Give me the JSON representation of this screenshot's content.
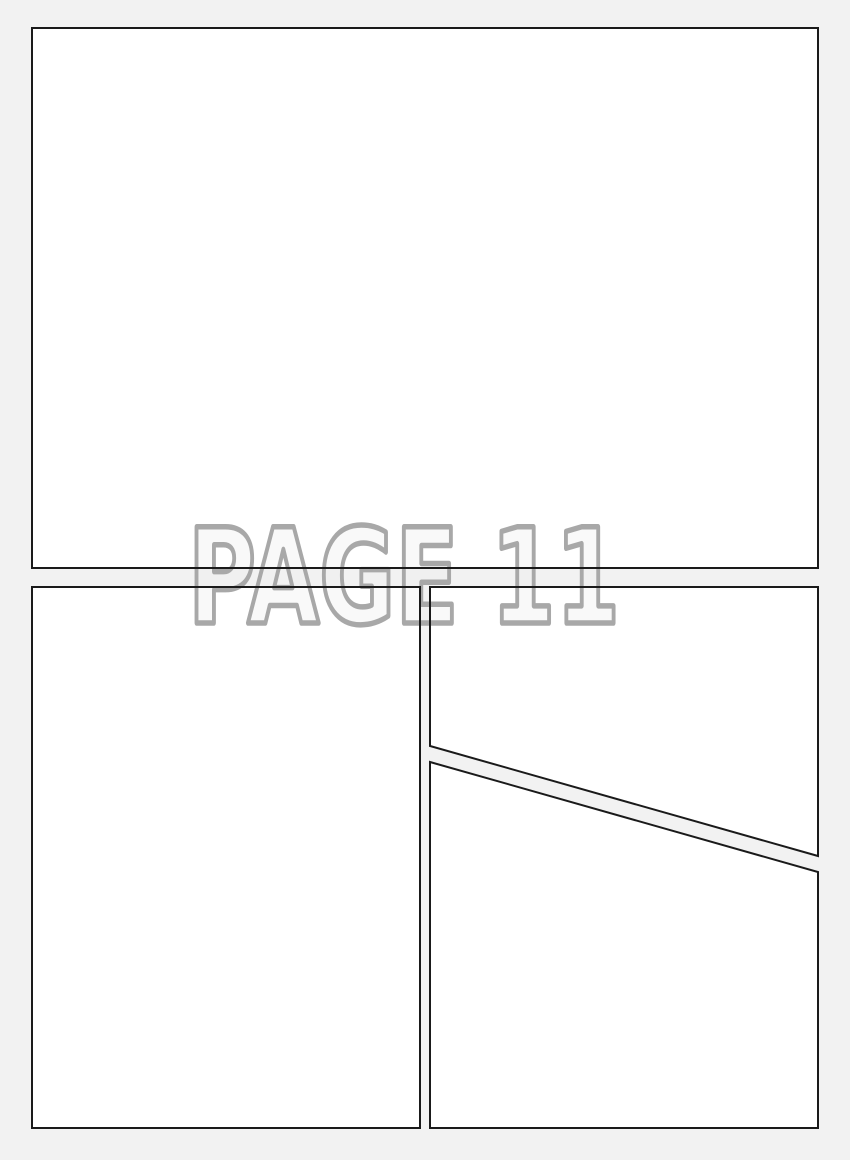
{
  "watermark": {
    "text": "PAGE 11"
  },
  "colors": {
    "background": "#f2f2f2",
    "panel_fill": "#ffffff",
    "panel_border": "#1a1a1a",
    "watermark_outline": "#a8a8a8"
  }
}
